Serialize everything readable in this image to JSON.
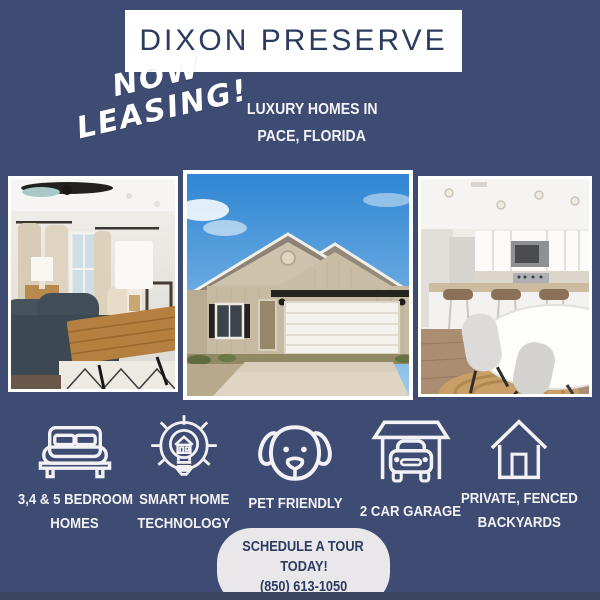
{
  "page": {
    "background_color": "#3e4b72",
    "accent_navy": "#2c3b60",
    "pill_color": "#e9e7ea",
    "text_white": "#f2f1f4"
  },
  "header": {
    "title": "DIXON PRESERVE",
    "badge_line1": "NOW",
    "badge_line2": "LEASING!",
    "subtitle_line1": "LUXURY HOMES IN",
    "subtitle_line2": "PACE, FLORIDA"
  },
  "photos": [
    {
      "name": "living-room-photo"
    },
    {
      "name": "house-exterior-photo"
    },
    {
      "name": "kitchen-dining-photo"
    }
  ],
  "features": [
    {
      "icon": "bed-icon",
      "line1": "3,4 & 5 BEDROOM",
      "line2": "HOMES"
    },
    {
      "icon": "smart-home-bulb-icon",
      "line1": "SMART HOME",
      "line2": "TECHNOLOGY"
    },
    {
      "icon": "dog-icon",
      "line1": "PET FRIENDLY",
      "line2": ""
    },
    {
      "icon": "garage-car-icon",
      "line1": "2 CAR GARAGE",
      "line2": ""
    },
    {
      "icon": "house-icon",
      "line1": "PRIVATE, FENCED",
      "line2": "BACKYARDS"
    }
  ],
  "cta": {
    "line1": "SCHEDULE A TOUR",
    "line2": "TODAY!",
    "phone": "(850) 613-1050"
  }
}
